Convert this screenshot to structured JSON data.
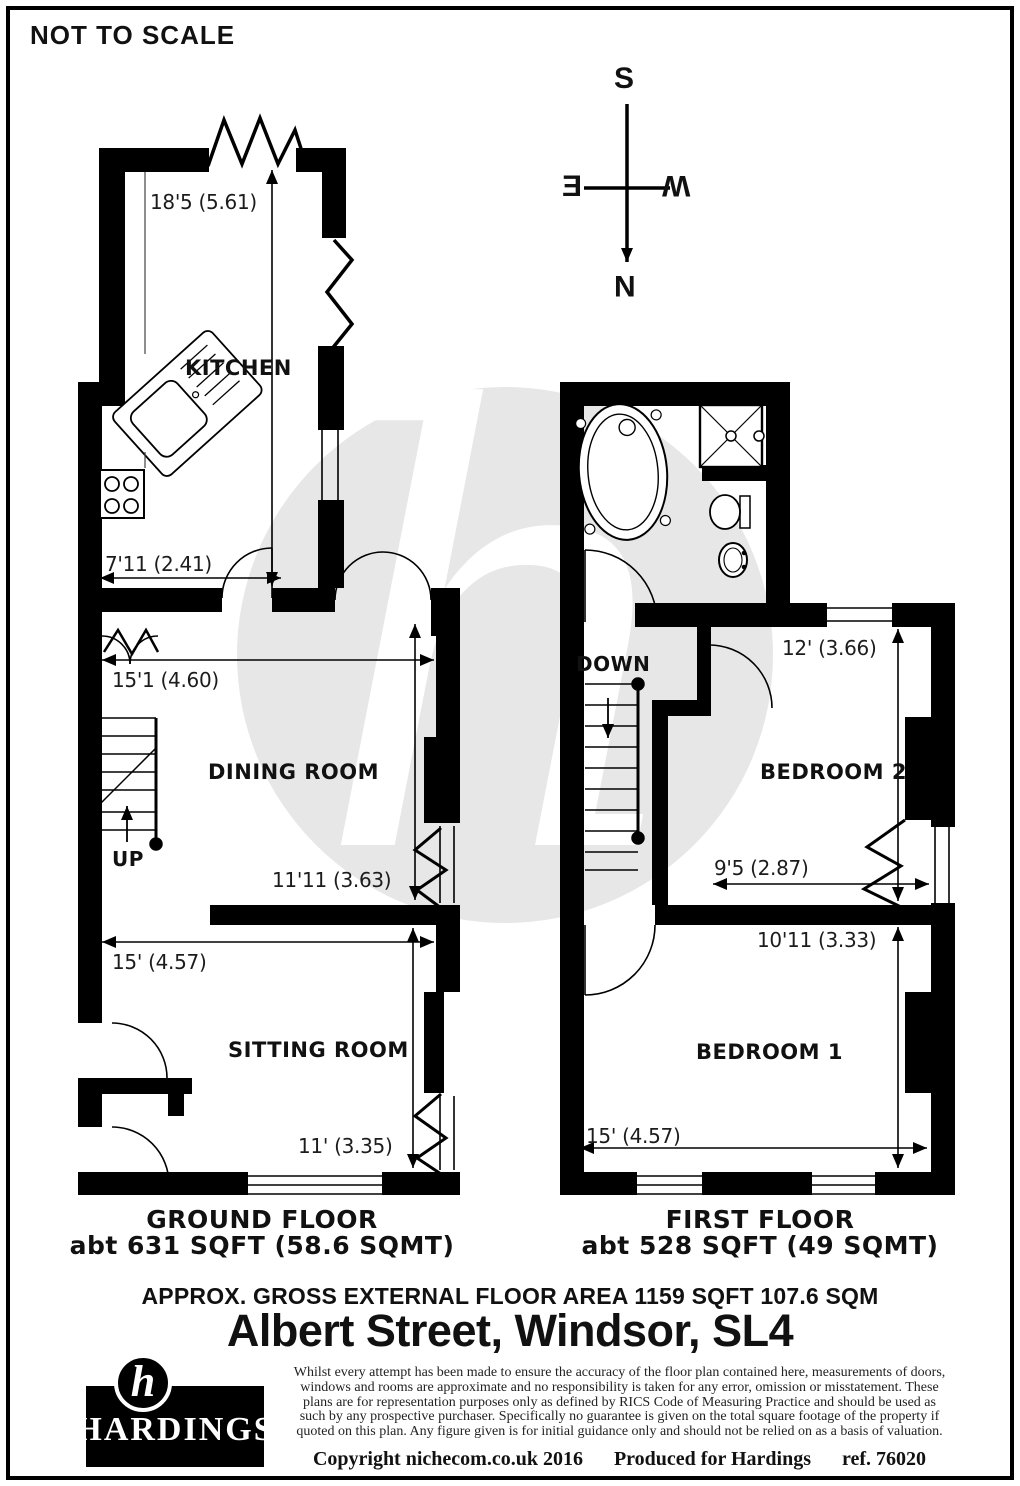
{
  "page": {
    "scale_note": "NOT TO SCALE"
  },
  "compass": {
    "n": "N",
    "s": "S",
    "e": "E",
    "w": "W"
  },
  "watermark": {
    "letter": "h"
  },
  "ground_floor": {
    "title": "GROUND FLOOR",
    "area": "abt 631 SQFT (58.6 SQMT)",
    "stairs": "UP",
    "kitchen": {
      "name": "KITCHEN",
      "length": "18'5 (5.61)",
      "width": "7'11 (2.41)"
    },
    "dining": {
      "name": "DINING ROOM",
      "width": "15'1 (4.60)",
      "length": "11'11 (3.63)"
    },
    "sitting": {
      "name": "SITTING ROOM",
      "width": "15' (4.57)",
      "length": "11' (3.35)"
    }
  },
  "first_floor": {
    "title": "FIRST FLOOR",
    "area": "abt 528 SQFT (49 SQMT)",
    "stairs": "DOWN",
    "bedroom2": {
      "name": "BEDROOM 2",
      "length": "12' (3.66)",
      "width": "9'5 (2.87)"
    },
    "bedroom1": {
      "name": "BEDROOM 1",
      "length": "10'11 (3.33)",
      "width": "15' (4.57)"
    }
  },
  "summary": {
    "gross_area": "APPROX. GROSS EXTERNAL FLOOR AREA 1159 SQFT 107.6 SQM",
    "address": "Albert Street, Windsor, SL4"
  },
  "branding": {
    "initial": "h",
    "name": "HARDINGS"
  },
  "legal": {
    "disclaimer": "Whilst every attempt has been made to ensure the accuracy of the floor plan contained here, measurements of doors, windows and rooms are approximate and no responsibility is taken for any error, omission or misstatement. These plans are for representation purposes only as defined by RICS Code of Measuring Practice and should be used as such by any prospective purchaser. Specifically no guarantee is given on the total square footage of the property if quoted on this plan. Any figure given is for initial guidance only and should not be relied on as a basis of valuation.",
    "copyright": "Copyright nichecom.co.uk 2016",
    "produced": "Produced for Hardings",
    "ref": "ref. 76020"
  },
  "colors": {
    "wall": "#000000",
    "watermark": "#e7e7e7",
    "text": "#111111"
  }
}
